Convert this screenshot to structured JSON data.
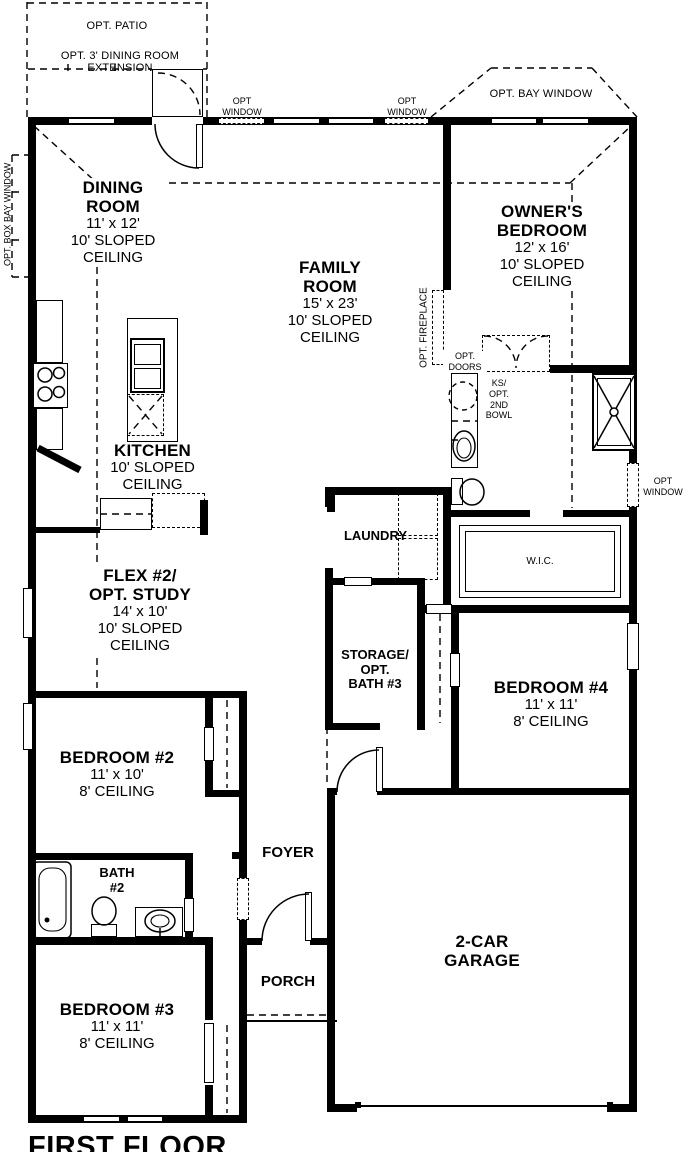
{
  "plan": {
    "title": "FIRST FLOOR",
    "colors": {
      "wall": "#000000",
      "background": "#ffffff"
    },
    "rooms": {
      "dining": {
        "name1": "DINING",
        "name2": "ROOM",
        "dims": "11' x 12'",
        "ceil1": "10' SLOPED",
        "ceil2": "CEILING"
      },
      "family": {
        "name1": "FAMILY",
        "name2": "ROOM",
        "dims": "15' x 23'",
        "ceil1": "10' SLOPED",
        "ceil2": "CEILING"
      },
      "owner": {
        "name1": "OWNER'S",
        "name2": "BEDROOM",
        "dims": "12' x 16'",
        "ceil1": "10' SLOPED",
        "ceil2": "CEILING"
      },
      "kitchen": {
        "name1": "KITCHEN",
        "ceil1": "10' SLOPED",
        "ceil2": "CEILING"
      },
      "flex": {
        "name1": "FLEX #2/",
        "name2": "OPT. STUDY",
        "dims": "14' x 10'",
        "ceil1": "10' SLOPED",
        "ceil2": "CEILING"
      },
      "bedroom2": {
        "name1": "BEDROOM #2",
        "dims": "11' x 10'",
        "ceil1": "8' CEILING"
      },
      "bedroom3": {
        "name1": "BEDROOM #3",
        "dims": "11' x 11'",
        "ceil1": "8' CEILING"
      },
      "bedroom4": {
        "name1": "BEDROOM #4",
        "dims": "11' x 11'",
        "ceil1": "8' CEILING"
      },
      "laundry": {
        "name1": "LAUNDRY"
      },
      "storage": {
        "name1": "STORAGE/",
        "name2": "OPT.",
        "name3": "BATH #3"
      },
      "wic": {
        "name1": "W.I.C."
      },
      "foyer": {
        "name1": "FOYER"
      },
      "porch": {
        "name1": "PORCH"
      },
      "garage": {
        "name1": "2-CAR",
        "name2": "GARAGE"
      },
      "bath2": {
        "name1": "BATH",
        "name2": "#2"
      }
    },
    "options": {
      "patio": "OPT. PATIO",
      "dining_extension": "OPT. 3' DINING ROOM EXTENSION",
      "window1": "OPT",
      "window2": "WINDOW",
      "bay_window": "OPT. BAY WINDOW",
      "box_bay_window": "OPT. BOX BAY WINDOW",
      "fireplace": "OPT. FIREPLACE",
      "doors1": "OPT.",
      "doors2": "DOORS",
      "ks1": "KS/",
      "ks2": "OPT.",
      "ks3": "2ND",
      "ks4": "BOWL"
    }
  }
}
